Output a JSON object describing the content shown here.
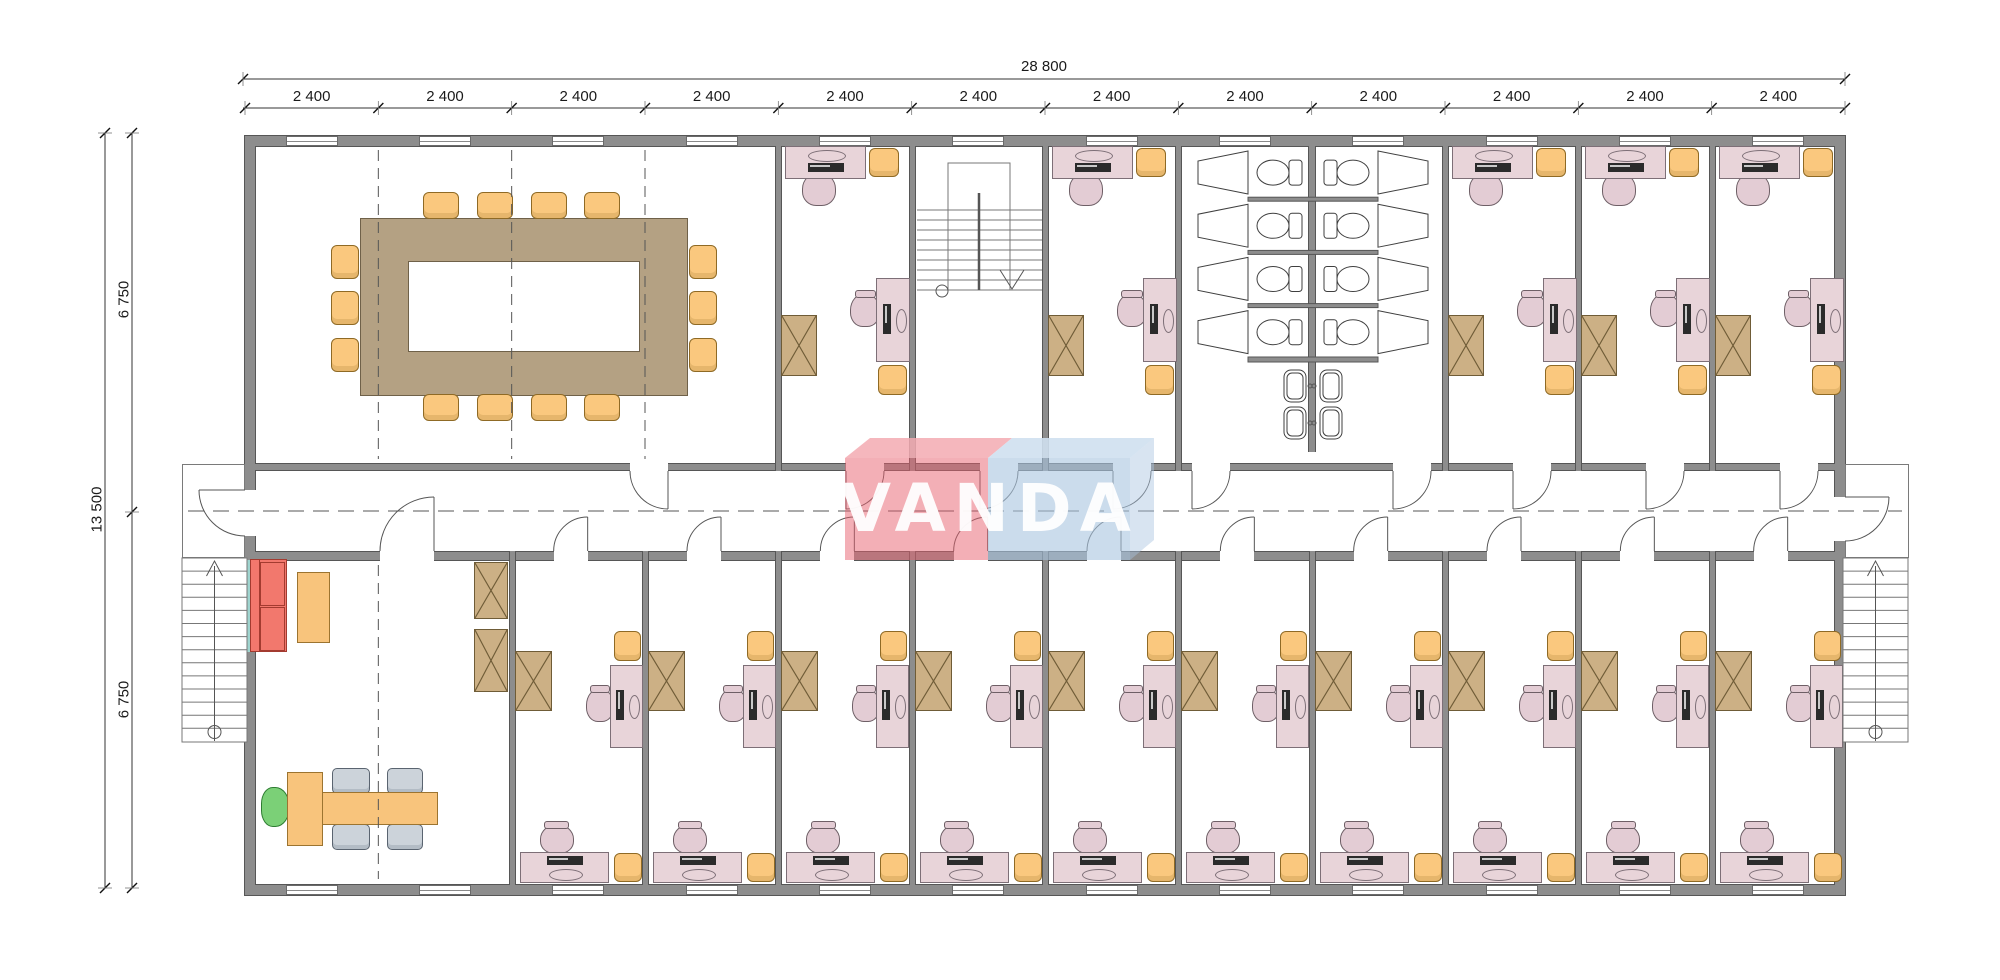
{
  "title": "Office building floor plan",
  "logo": {
    "text": "VANDA"
  },
  "dimensions": {
    "total_width_label": "28 800",
    "bay_label": "2 400",
    "bay_count": 12,
    "total_height_label": "13 500",
    "half_height_label": "6 750",
    "half_count": 2
  },
  "rooms": {
    "meeting_room": {
      "bays": 4,
      "conference_chairs": 14
    },
    "top_offices": {
      "count": 5,
      "bay_index": [
        4,
        6,
        9,
        10,
        11
      ]
    },
    "bottom_offices": {
      "count": 10,
      "bay_index": [
        2,
        3,
        4,
        5,
        6,
        7,
        8,
        9,
        10,
        11
      ]
    },
    "lounge_office": {
      "sofas": 1,
      "coffee_tables": 1,
      "guest_chairs": 4,
      "exec_chairs": 1,
      "cabinets": 2
    },
    "toilet_block": {
      "stall_rows": 4,
      "stalls": 8,
      "sinks": 4
    },
    "staircases": {
      "internal": 1,
      "external": 2
    }
  },
  "colors": {
    "wall": "#8d8d8d",
    "wall_edge": "#565656",
    "floor": "#ffffff",
    "desk": "#e8d4d9",
    "desk_edge": "#7d6f77",
    "chair": "#e3ccd4",
    "chair_edge": "#6e5f66",
    "armchair": "#fac87e",
    "armchair_edge": "#8f6a25",
    "cabinet": "#ccb085",
    "cabinet_edge": "#6f5c37",
    "conference_table": "#b4a183",
    "conference_table_edge": "#6f6149",
    "sofa": "#f2786d",
    "sofa_edge": "#a33b30",
    "coffee_table": "#f8c47c",
    "coffee_table_edge": "#9c7430",
    "exec_chair": "#7bd077",
    "exec_chair_edge": "#2e7d32",
    "guest_chair": "#ccd3da",
    "guest_chair_edge": "#5a6470",
    "monitor": "#2b2b2b",
    "line": "#3f3f3f",
    "dim_text": "#1a1a1a",
    "accent_teal": "#9fd4cf",
    "logo_red": "#e8606e",
    "logo_red_top": "#f3aab1",
    "logo_blue": "#a8c4e0",
    "logo_blue_top": "#cfe0f0",
    "logo_text": "#ffffff"
  }
}
